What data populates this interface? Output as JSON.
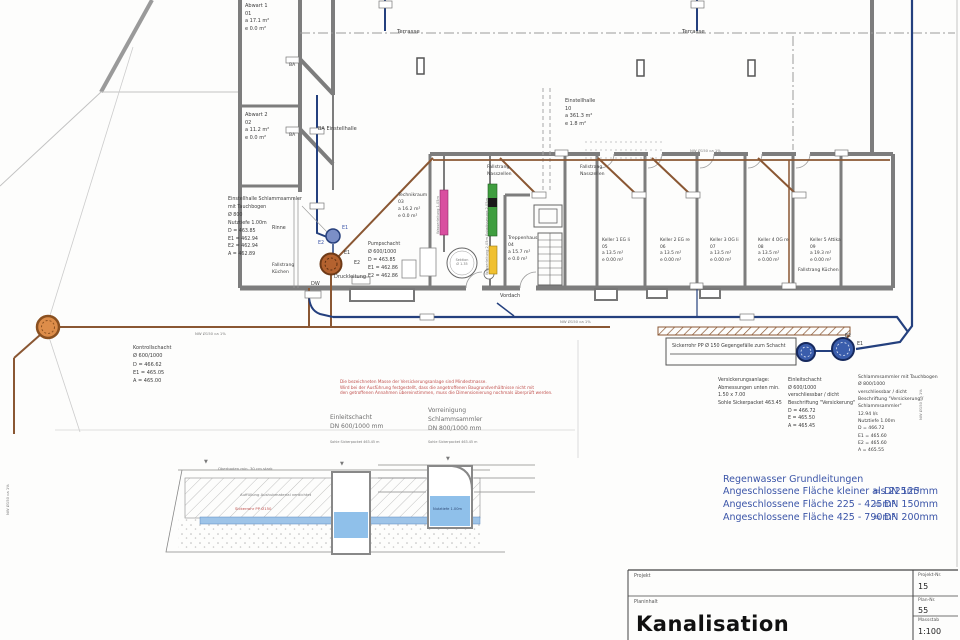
{
  "drawing": {
    "rooms": {
      "abwart1": [
        "Abwart 1",
        "01",
        "a 17.1 m²",
        "e 0.0 m²"
      ],
      "abwart2": [
        "Abwart 2",
        "02",
        "a 11.2 m²",
        "e 0.0 m²"
      ],
      "einstellhalle": [
        "Einstellhalle",
        "10",
        "a 361.3 m²",
        "e 1.8 m²"
      ],
      "technikraum": [
        "Technikraum",
        "03",
        "a 16.2 m²",
        "e 0.0 m²"
      ],
      "treppenhaus": [
        "Treppenhaus",
        "04",
        "a 15.7 m²",
        "e 0.0 m²"
      ],
      "keller1": [
        "Keller 1 EG li",
        "05",
        "a 13.5 m²",
        "e 0.00 m²"
      ],
      "keller2": [
        "Keller 2 EG re",
        "06",
        "a 13.5 m²",
        "e 0.00 m²"
      ],
      "keller3": [
        "Keller 3 OG li",
        "07",
        "a 13.5 m²",
        "e 0.00 m²"
      ],
      "keller4": [
        "Keller 4 OG re",
        "08",
        "a 13.5 m²",
        "e 0.00 m²"
      ],
      "keller5": [
        "Keller 5 Attika",
        "09",
        "a 19.3 m²",
        "e 0.00 m²"
      ],
      "ba_einstellhalle": "BA Einstellhalle",
      "ba": "BA"
    },
    "labels": {
      "terrasse": "Terrasse",
      "rinne": "Rinne",
      "dw": "DW",
      "druckleitung": "Druckleitung",
      "vordach": "Vordach",
      "e1": "E1",
      "e2": "E2",
      "fallstrang_nasszellen": [
        "Fallstrang",
        "Nasszellen"
      ],
      "fallstrang_kuechen": [
        "Fallstrang",
        "Küchen"
      ],
      "fallstrang_kuechen_right": "Fallstrang Küchen",
      "pipe_nw": "NW Ø150 ca 1%",
      "sektion": [
        "Sektion",
        "Ø 1.35"
      ],
      "bar_pink": "Wasserleitung 1.05m",
      "bar_green": "Entwässerung 2.05m",
      "bar_yellow": "Wasserleitung 2.05m"
    },
    "shafts": {
      "einstellhalle_schlammsammler": [
        "Einstellhalle Schlammsammler",
        "mit Tauchbogen",
        "Ø 800",
        "Nutztiefe 1.00m",
        "D = 463.85",
        "E1 = 462.94",
        "E2 = 462.94",
        "A = 462.89"
      ],
      "pumpschacht": [
        "Pumpschacht",
        "Ø 600/1000",
        "D = 463.85",
        "E1 = 462.86",
        "E2 = 462.86"
      ],
      "kontrollschacht": [
        "Kontrollschacht",
        "Ø 600/1000",
        "D = 466.62",
        "E1 = 465.05",
        "A = 465.00"
      ],
      "sickerrohr": "Sickerrohr PP Ø 150 Gegengefälle zum Schacht",
      "versickerungsanlage": [
        "Versickerungsanlage:",
        "Abmessungen unten min.",
        "1.50 x 7.00",
        "Sohle Sickerpacket 463.45"
      ],
      "einleitschacht": [
        "Einleitschacht",
        "Ø 600/1000",
        "verschliessbar / dicht",
        "Beschriftung \"Versickerung\"",
        "D = 466.72",
        "E = 465.50",
        "A = 465.45"
      ],
      "schlammsammler": [
        "Schlammsammler mit Tauchbogen",
        "Ø 800/1000",
        "verschliessbar / dicht",
        "Beschriftung \"Versickerung /",
        "Schlammsammler\"",
        "12.94 l/s",
        "Nutztiefe 1.00m",
        "D = 466.72",
        "E1 = 465.60",
        "E2 = 465.60",
        "A = 465.55"
      ]
    },
    "details": {
      "red_note": [
        "Die bezeichneten Masse der Versickerungsanlage sind Mindestmasse.",
        "Wird bei der Ausführung festgestellt, dass die angetroffenen Baugrundverhältnisse nicht mit",
        "den getroffenen Annahmen übereinstimmen, muss die Dimensionierung nochmals überprüft werden."
      ],
      "left_title": [
        "Einleitschacht",
        "DN 600/1000 mm"
      ],
      "right_title": [
        "Vorreinigung",
        "Schlammsammler",
        "DN 800/1000 mm"
      ],
      "left_sub": "Sohle Sickerpacket 463.45 m",
      "right_sub": "Sohle Sickerpacket 463.45 m",
      "oberboden": "Oberboden min. 30 cm stark",
      "auffuellung": "Auffüllung Aushubmaterial verdichtet",
      "sickerrohr_red": "Sickerrohr PP Ø150",
      "nutztiefe": "Nutztiefe 1.00m"
    },
    "legend": {
      "title": "Regenwasser Grundleitungen",
      "rows": [
        {
          "flaeche": "Angeschlossene Fläche kleiner als 225m³",
          "dn": "= DN 125mm"
        },
        {
          "flaeche": "Angeschlossene Fläche 225 - 425m³",
          "dn": "= DN 150mm"
        },
        {
          "flaeche": "Angeschlossene Fläche 425 - 790m³",
          "dn": "= DN 200mm"
        }
      ]
    },
    "titleblock": {
      "projekt_label": "Projekt",
      "projekt_nr_label": "Projekt-Nr.",
      "projekt_nr": "15",
      "planinhalt_label": "Planinhalt",
      "plan_title": "Kanalisation",
      "plan_nr_label": "Plan-Nr.",
      "plan_nr": "55",
      "massstab_label": "Massstab",
      "massstab": "1:100"
    },
    "colors": {
      "sewage_brown": "#8a5733",
      "rainwater_navy": "#24407e",
      "legend_blue": "#3b55a8",
      "note_red": "#c0504d",
      "wall_gray": "#7d7d7d"
    }
  }
}
